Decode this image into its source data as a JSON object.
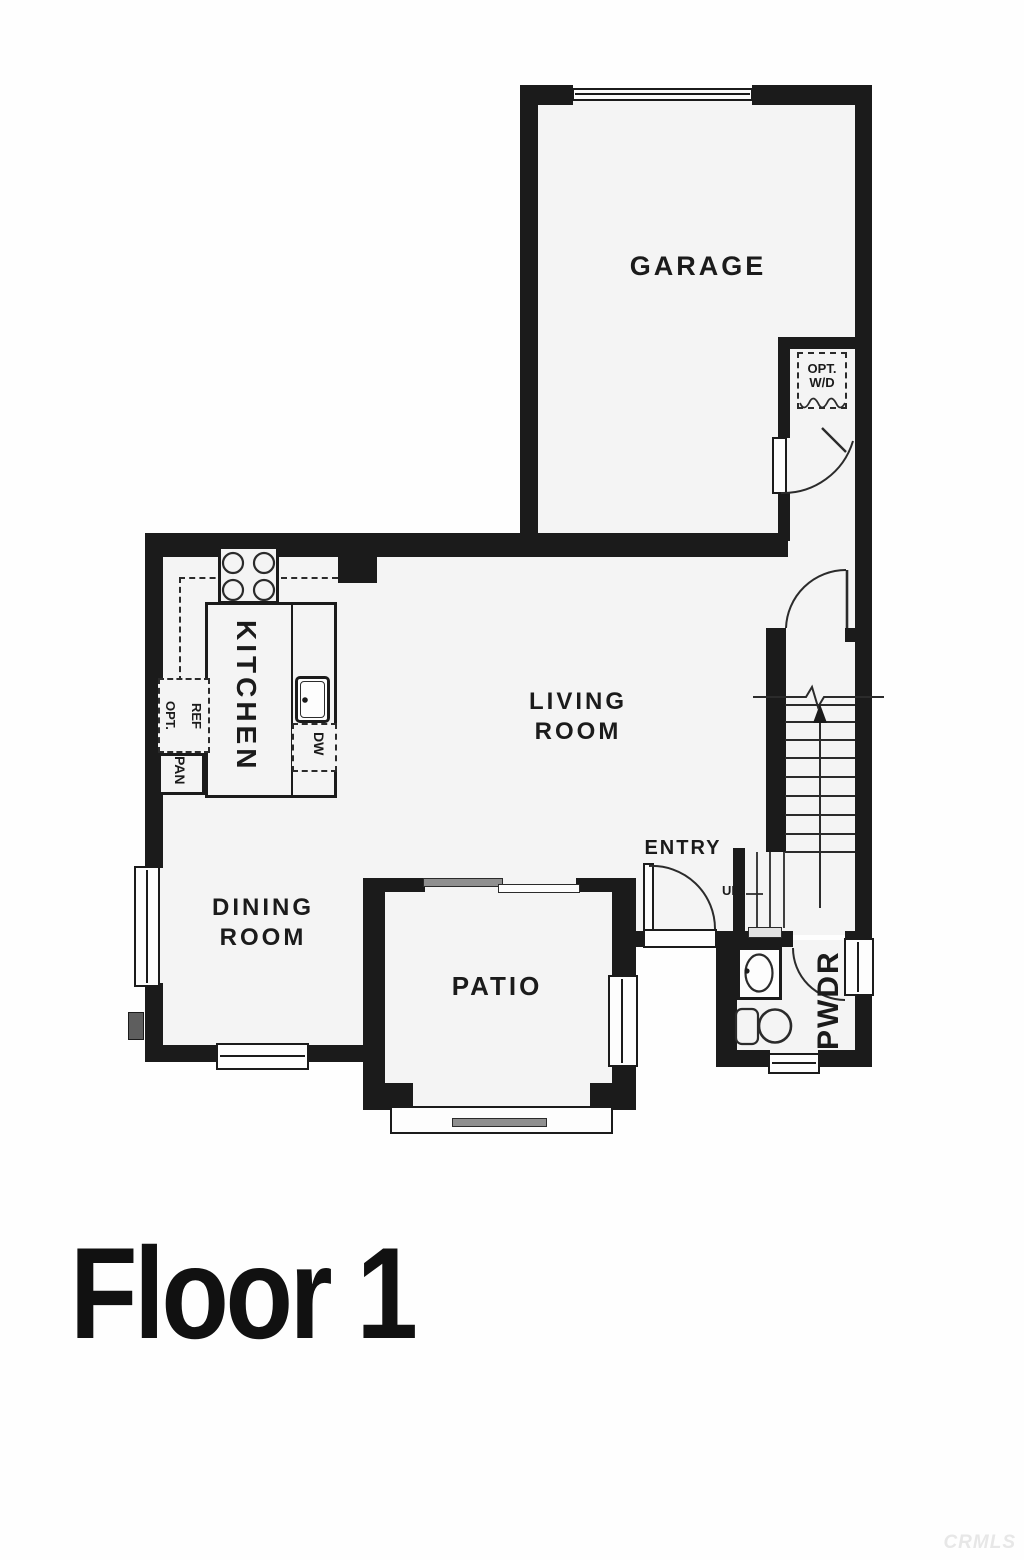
{
  "title": "Floor 1",
  "watermark": "CRMLS",
  "rooms": {
    "garage": "GARAGE",
    "kitchen": "KITCHEN",
    "living": {
      "line1": "LIVING",
      "line2": "ROOM"
    },
    "dining": {
      "line1": "DINING",
      "line2": "ROOM"
    },
    "patio": "PATIO",
    "entry": "ENTRY",
    "powder": "PWDR"
  },
  "labels": {
    "up": "UP",
    "washer_dryer": {
      "line1": "OPT.",
      "line2": "W/D"
    },
    "refrigerator": {
      "line1": "OPT.",
      "line2": "REF"
    },
    "pantry": "PAN",
    "dishwasher": "DW"
  },
  "colors": {
    "wall": "#1b1b1b",
    "room_fill": "#f4f4f4",
    "line": "#2b2b2b",
    "slider_gray": "#8f8f8f",
    "watermark": "#e7e7e7"
  }
}
